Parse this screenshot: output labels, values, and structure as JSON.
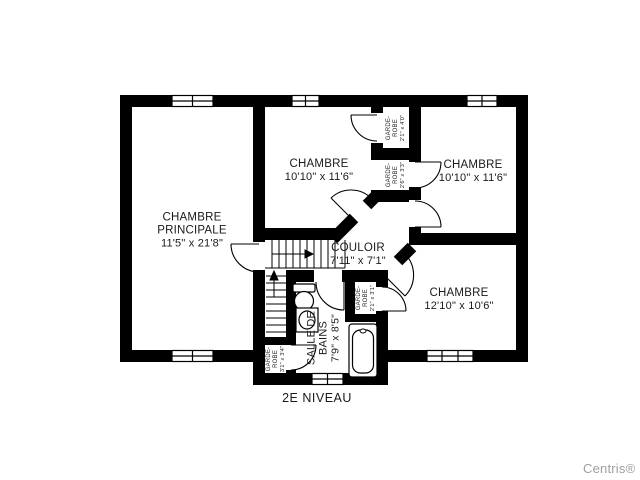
{
  "page": {
    "level_label": "2E NIVEAU",
    "watermark": "Centris®",
    "background": "#ffffff"
  },
  "colors": {
    "walls": "#000000",
    "text": "#1a1a1a",
    "watermark_gray": "#9e9e9e"
  },
  "rooms": {
    "master": {
      "name": "CHAMBRE PRINCIPALE",
      "dims": "11'5\" x 21'8\""
    },
    "bedroom_top_middle": {
      "name": "CHAMBRE",
      "dims": "10'10\" x 11'6\""
    },
    "bedroom_top_right": {
      "name": "CHAMBRE",
      "dims": "10'10\" x 11'6\""
    },
    "bedroom_bottom_right": {
      "name": "CHAMBRE",
      "dims": "12'10\" x 10'6\""
    },
    "hallway": {
      "name": "COULOIR",
      "dims": "7'11\" x 7'1\""
    },
    "bathroom": {
      "name": "SALLE DE BAINS",
      "dims": "7'9\" x 8'5\""
    }
  },
  "closets": {
    "top_right_upper": {
      "name": "GARDE-ROBE",
      "dims": "2'1\" x 4'0\""
    },
    "top_right_lower": {
      "name": "GARDE-ROBE",
      "dims": "2'6\" x 3'3\""
    },
    "center": {
      "name": "GARDE-ROBE",
      "dims": "2'1\" x 3'1\""
    },
    "bottom_left": {
      "name": "GARDE-ROBE",
      "dims": "3'1\" x 3'4\""
    }
  },
  "icons": {
    "toilet": "toilet-icon",
    "sink": "sink-icon",
    "bathtub": "bathtub-icon",
    "stairs": "staircase",
    "window": "window-icon",
    "door": "door-swing-icon"
  }
}
